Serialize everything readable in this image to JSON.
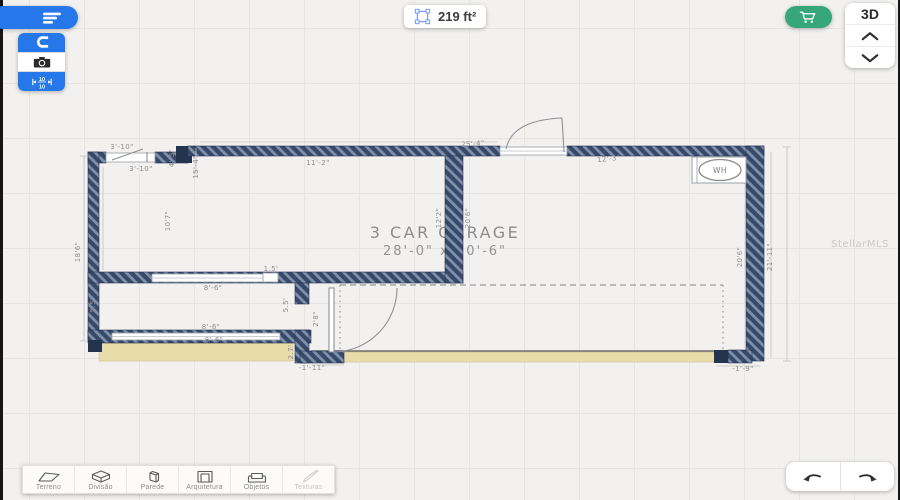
{
  "top_bar": {
    "menu_button": {
      "icon": "menu-lines-icon",
      "bg": "#2677e9"
    },
    "tool_group": {
      "magnet": {
        "icon": "magnet-icon",
        "bg": "#2677e9"
      },
      "camera": {
        "icon": "camera-icon",
        "bg": "#ffffff"
      },
      "dimensions": {
        "icon": "dimension-10-10-icon",
        "bg": "#2677e9",
        "top": "10",
        "bottom": "10"
      }
    },
    "area_badge": {
      "icon": "area-select-icon",
      "icon_color": "#7ba2ec",
      "value": "219 ft²"
    },
    "cart_button": {
      "icon": "cart-icon",
      "bg": "#37a67b"
    },
    "view_switcher": {
      "label": "3D",
      "up_icon": "chevron-up-icon",
      "down_icon": "chevron-down-icon"
    }
  },
  "canvas": {
    "title_line1": "3 CAR GARAGE",
    "title_line2": "28'-0\" x 20'-6\"",
    "wh_label": "WH",
    "watermark": "StellarMLS",
    "colors": {
      "wall": "#3c5170",
      "wall_stripe": "#7f90a9",
      "driveway_tan": "#e8dcab"
    },
    "dimensions": [
      {
        "t": "3'-10\"",
        "x": 122,
        "y": 149,
        "r": 0
      },
      {
        "t": "3'-10\"",
        "x": 141,
        "y": 171,
        "r": 0
      },
      {
        "t": "4'-5\"",
        "x": 174,
        "y": 158,
        "r": -90
      },
      {
        "t": "15'-4\"",
        "x": 198,
        "y": 167,
        "r": -90
      },
      {
        "t": "11'-2\"",
        "x": 318,
        "y": 165,
        "r": 0
      },
      {
        "t": "25'-4\"",
        "x": 473,
        "y": 146,
        "r": -4
      },
      {
        "t": "12'-3\"",
        "x": 609,
        "y": 161,
        "r": -6
      },
      {
        "t": "18'6\"",
        "x": 80,
        "y": 252,
        "r": -90
      },
      {
        "t": "10'7\"",
        "x": 170,
        "y": 221,
        "r": -90
      },
      {
        "t": "12'2\"",
        "x": 441,
        "y": 218,
        "r": -90
      },
      {
        "t": "20'6\"",
        "x": 470,
        "y": 218,
        "r": -90
      },
      {
        "t": "1.5'",
        "x": 271,
        "y": 271,
        "r": 0
      },
      {
        "t": "8'-6\"",
        "x": 213,
        "y": 290,
        "r": 0
      },
      {
        "t": "5.5'",
        "x": 95,
        "y": 305,
        "r": -90
      },
      {
        "t": "5.5'",
        "x": 288,
        "y": 305,
        "r": -90
      },
      {
        "t": "2'8\"",
        "x": 318,
        "y": 319,
        "r": -90
      },
      {
        "t": "8'-6\"",
        "x": 211,
        "y": 329,
        "r": 0
      },
      {
        "t": "8'-6\"",
        "x": 214,
        "y": 342,
        "r": 0
      },
      {
        "t": "2.7'",
        "x": 293,
        "y": 352,
        "r": -90
      },
      {
        "t": "-1'-11\"",
        "x": 312,
        "y": 370,
        "r": 0
      },
      {
        "t": "-1'-9\"",
        "x": 743,
        "y": 371,
        "r": 0
      },
      {
        "t": "20'6\"",
        "x": 742,
        "y": 257,
        "r": -90
      },
      {
        "t": "21'-11\"",
        "x": 772,
        "y": 257,
        "r": -90
      }
    ]
  },
  "toolbar": {
    "items": [
      {
        "id": "terreno",
        "label": "Terreno",
        "icon": "terrain-icon",
        "disabled": false
      },
      {
        "id": "divisao",
        "label": "Divisão",
        "icon": "room-box-icon",
        "disabled": false
      },
      {
        "id": "parede",
        "label": "Parede",
        "icon": "wall-icon",
        "disabled": false
      },
      {
        "id": "arquitetura",
        "label": "Arquitetura",
        "icon": "door-frame-icon",
        "disabled": false
      },
      {
        "id": "objetos",
        "label": "Objetos",
        "icon": "sofa-icon",
        "disabled": false
      },
      {
        "id": "texturas",
        "label": "Texturas",
        "icon": "paint-brush-icon",
        "disabled": true
      }
    ]
  },
  "history": {
    "undo_icon": "undo-arrow-icon",
    "redo_icon": "redo-arrow-icon"
  }
}
